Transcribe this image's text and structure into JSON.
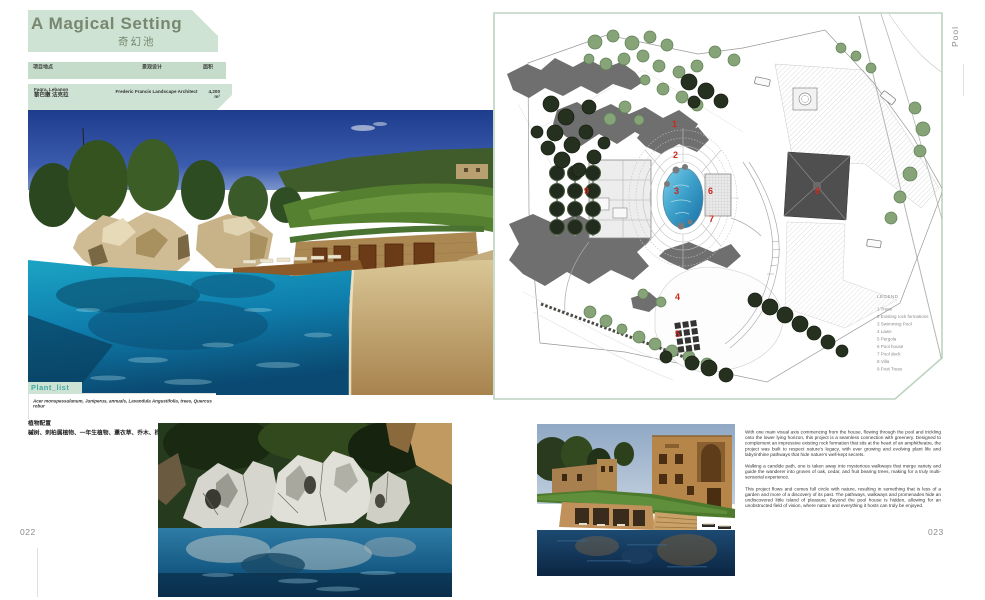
{
  "page": {
    "left_number": "022",
    "right_number": "023",
    "side_label": "Pool"
  },
  "header": {
    "title": "A Magical Setting",
    "title_zh": "奇幻池",
    "meta": {
      "col1_label": "项目地点",
      "col2_label": "景观设计",
      "col3_label": "面积",
      "col1_value": "Faqra, Lebanon",
      "col1_value_zh": "黎巴嫩 法克拉",
      "col2_value": "Frederic Francis Landscape Architect",
      "col3_value": "4,200 m²"
    }
  },
  "plant": {
    "label": "Plant_list",
    "list_en": "Acer monspessulanum, Juniperus, annuals, Lavandula Angustifolia, trees, Quercus robur",
    "label_zh": "植物配置",
    "list_zh": "槭树、刺柏属植物、一年生植物、薰衣草、乔木、栎树"
  },
  "plan": {
    "legend_title": "LEGEND",
    "legend": [
      "1 Trees",
      "2 Existing rock formations",
      "3 Swimming Pool",
      "4 Lawn",
      "5 Pergola",
      "6 Pool house",
      "7 Pool deck",
      "8 Villa",
      "9 Fruit Trees"
    ],
    "marker_numbers": [
      "1",
      "2",
      "3",
      "4",
      "5",
      "6",
      "7",
      "8",
      "9"
    ]
  },
  "article": {
    "paragraphs": [
      "With one main visual axis commencing from the house, flowing through the pool and trickling onto the lower lying horizon, this project is a seamless connection with greenery. Designed to complement an impressive existing rock formation that sits at the heart of an amphitheatre, the project was built to respect nature's legacy, with ever growing and evolving plant life and labyrinthine pathways that hide nature's well-kept secrets.",
      "Walking a candide path, one is taken away into mysterious walkways that merge variety and guide the wanderer into groves of oak, cedar, and fruit bearing trees, making for a truly multi-sensorial experience.",
      "This project flows and comes full circle with nature, resulting in something that is less of a garden and more of a discovery of its past. The pathways, walkways and promenades hide an undiscovered little island of pleasure. Beyond the pool house is hidden, allowing for an unobstructed field of vision, where nature and everything it hosts can truly be enjoyed."
    ]
  }
}
